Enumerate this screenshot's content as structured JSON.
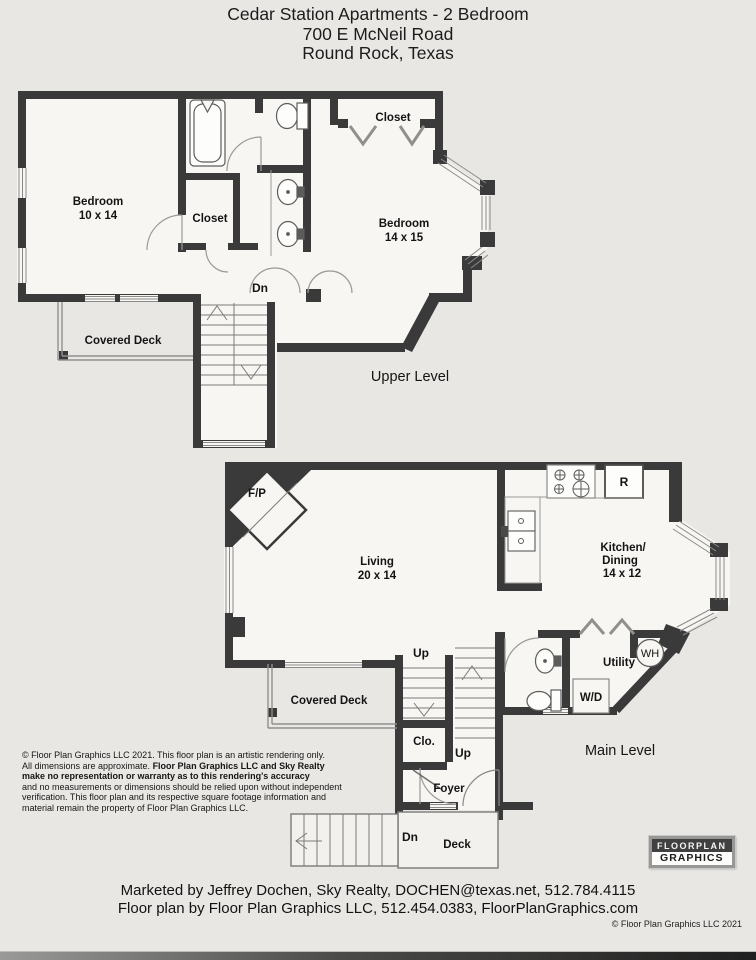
{
  "title": {
    "line1": "Cedar Station Apartments - 2 Bedroom",
    "line2": "700 E McNeil Road",
    "line3": "Round Rock, Texas"
  },
  "upper": {
    "caption": "Upper Level",
    "bedroom1_name": "Bedroom",
    "bedroom1_dim": "10 x 14",
    "closet_inner": "Closet",
    "closet_top": "Closet",
    "bedroom2_name": "Bedroom",
    "bedroom2_dim": "14 x 15",
    "covered_deck": "Covered Deck",
    "dn": "Dn"
  },
  "main": {
    "caption": "Main Level",
    "fireplace": "F/P",
    "living_name": "Living",
    "living_dim": "20 x 14",
    "kitchen_l1": "Kitchen/",
    "kitchen_l2": "Dining",
    "kitchen_dim": "14 x 12",
    "refrigerator": "R",
    "water_heater": "WH",
    "utility": "Utility",
    "washer_dryer": "W/D",
    "up1": "Up",
    "up2": "Up",
    "closet": "Clo.",
    "foyer": "Foyer",
    "covered_deck": "Covered Deck",
    "deck": "Deck",
    "dn": "Dn"
  },
  "disclaimer": {
    "l1": "© Floor Plan Graphics LLC 2021. This floor plan is an artistic rendering only.",
    "l2a": "All dimensions are approximate. ",
    "l2b": "Floor Plan Graphics LLC and Sky Realty",
    "l3": "make no representation or warranty as to this rendering's accuracy",
    "l4": "and no measurements or dimensions should be relied upon without independent",
    "l5": "verification. This floor plan and its respective square footage information and",
    "l6": "material remain the property of Floor Plan Graphics LLC."
  },
  "footer": {
    "line1": "Marketed by Jeffrey Dochen, Sky Realty, DOCHEN@texas.net, 512.784.4115",
    "line2": "Floor plan by Floor Plan Graphics LLC, 512.454.0383, FloorPlanGraphics.com",
    "copyright": "© Floor Plan Graphics LLC 2021"
  },
  "logo": {
    "top": "FLOORPLAN",
    "bottom": "GRAPHICS"
  },
  "colors": {
    "wall": "#3a3a3a",
    "paper": "#e8e7e4",
    "line": "#777777"
  }
}
